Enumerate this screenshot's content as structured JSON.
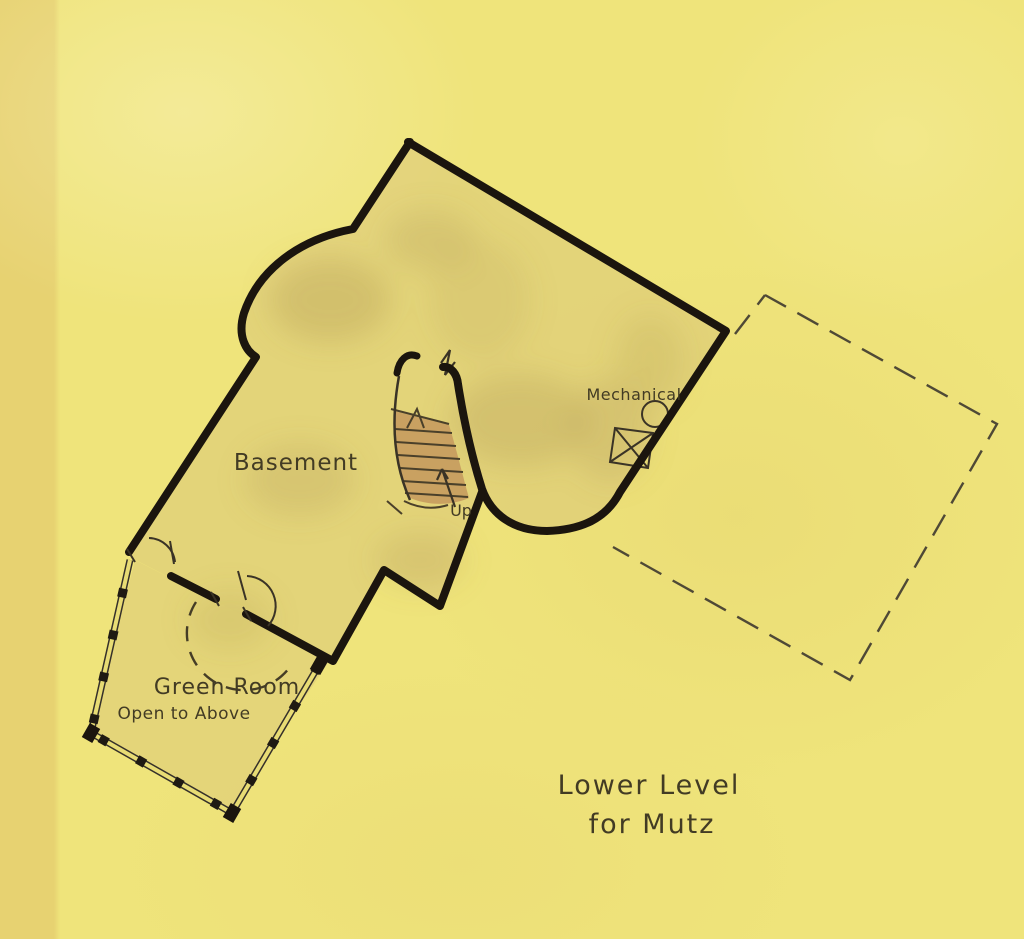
{
  "plan": {
    "title_line1": "Lower Level",
    "title_line2": "for Mutz",
    "rooms": {
      "basement": "Basement",
      "green_room": "Green Room",
      "green_room_note": "Open to Above",
      "mechanical": "Mechanical"
    },
    "stairs": {
      "direction_label": "Up"
    },
    "colors": {
      "paper": "#efe47b",
      "floor_wash": "#d7c377",
      "stair_fill": "#c79c60",
      "wall_ink": "#1b150e",
      "line_ink": "#3a3326",
      "text_ink": "#423b24"
    }
  }
}
